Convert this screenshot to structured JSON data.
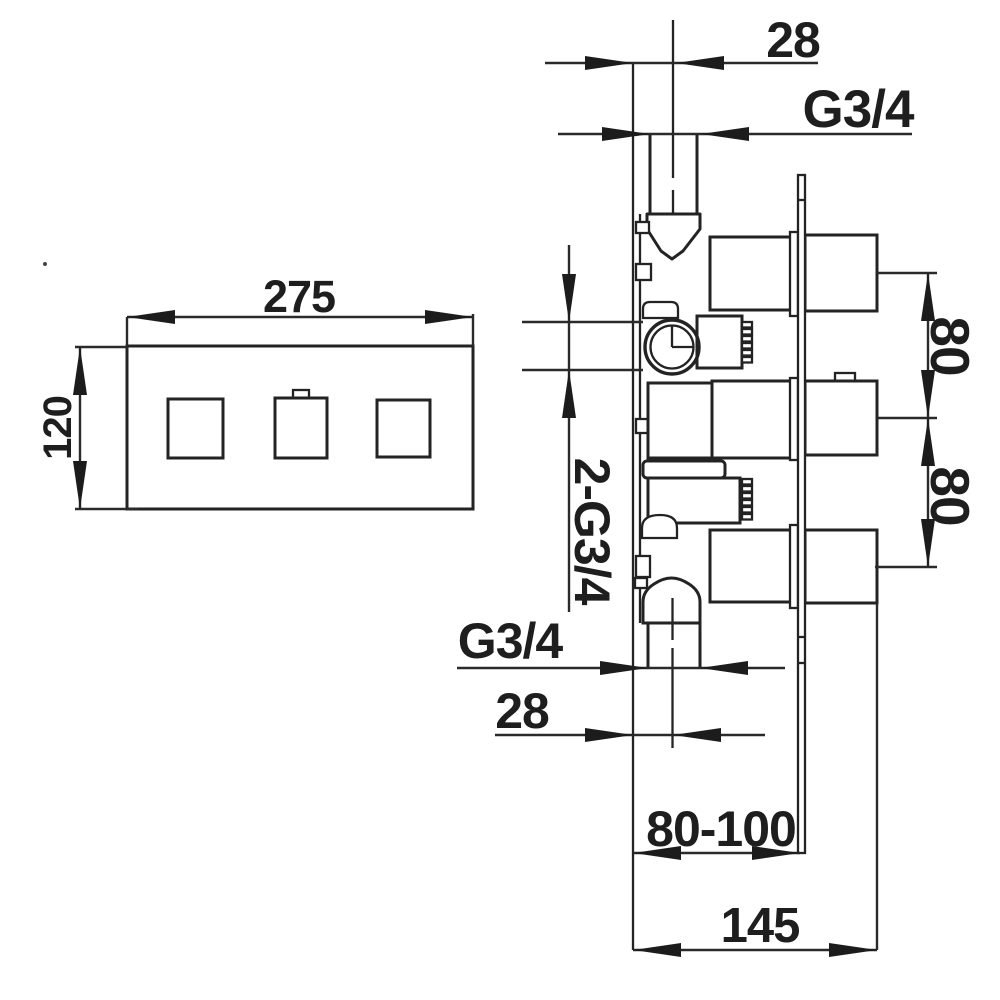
{
  "drawing": {
    "type": "technical-installation-drawing",
    "views": [
      "front-view-trim-plate",
      "side-section-valve-body"
    ],
    "colors": {
      "line": "#232323",
      "background": "#ffffff"
    },
    "front_view": {
      "width_label": "275",
      "height_label": "120"
    },
    "side_view": {
      "top_pipe_diameter": "28",
      "top_connection_thread": "G3/4",
      "side_connections": "2-G3/4",
      "upper_port_spacing": "80",
      "lower_port_spacing": "80",
      "bottom_connection_thread": "G3/4",
      "bottom_pipe_diameter": "28",
      "mounting_depth_range": "80-100",
      "overall_depth": "145"
    }
  }
}
